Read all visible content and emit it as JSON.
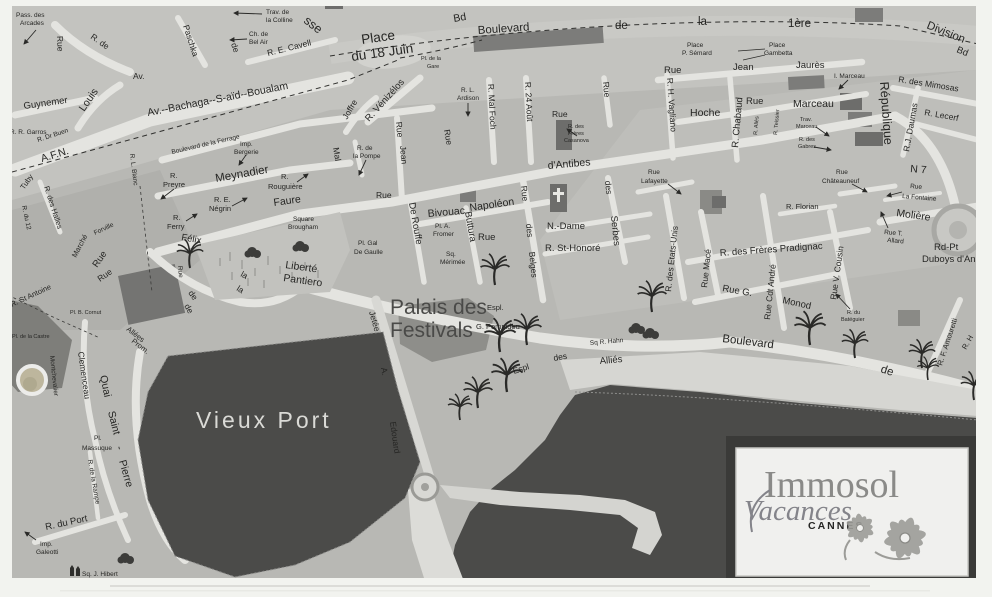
{
  "meta": {
    "description": "Scanned photocopy of a Cannes street map with Immosol Vacances agency logo",
    "colors": {
      "paper": "#f2f3ef",
      "land": "#b8b8b4",
      "road": "#e4e4e0",
      "water": "#4b4b49",
      "block": "#7c7c7a",
      "label": "#262624",
      "logo_gray": "#8a8a88",
      "pen_mark_blue": "#4a66c8"
    }
  },
  "labels": {
    "rue": "Rue",
    "de": "de",
    "la": "la",
    "arcades1": "Pass. des",
    "arcades2": "Arcades",
    "r_de_tl": "R. de",
    "av_tl": "Av.",
    "paschka": "Paschka",
    "colline1": "Trav. de",
    "colline2": "la Colline",
    "belair1": "Ch. de",
    "belair2": "Bel Air",
    "cavell": "R.  E.  Cavell",
    "sse": "sse",
    "place18a": "Place",
    "place18b": "du 18 Juin",
    "gare1": "Pl. de la",
    "gare2": "Gare",
    "bd1": "Bd",
    "blvd": "Boulevard",
    "blvd_la": "la",
    "blvd_1ere": "1ère",
    "blvd_div": "Division",
    "bd2": "Bd",
    "guynemer": "Guynemer",
    "louis": "Louis",
    "garros": "R. R. Garros",
    "buen": "R. Dr Buen",
    "afn": "A.F.N.",
    "bachaga": "Av.--Bachaga--S-aïd--Boualam",
    "ferrage": "Boulevard  de  la  Ferrage",
    "bergerie": "Bergerie",
    "imp": "Imp.",
    "meynadier": "Meynadier",
    "r": "R.",
    "preyre": "Preyre",
    "rouguiere": "Rouguière",
    "negrin1": "R. E.",
    "negrin2": "Négrin",
    "ferry": "Ferry",
    "felix": "Félix",
    "faure": "Faure",
    "brougham1": "Square",
    "brougham2": "Brougham",
    "liberte": "Liberté",
    "pantiero": "Pantiero",
    "gaulle1": "Pl. Gal",
    "gaulle2": "De Gaulle",
    "lblanc": "R. L. Blanc",
    "tuby": "Tuby",
    "halles": "R. des Halles",
    "du12": "R. du 12",
    "marche": "Marché",
    "forville": "Forville",
    "stantoine": "R. St Antoine",
    "castre": "Pl. de la Castre",
    "cornut": "Pl. B. Cornut",
    "montchev": "Montchevalier",
    "clemenceau": "Clemenceau",
    "quai": "Quai",
    "saint": "Saint",
    "tiret": "-",
    "pierre": "Pierre",
    "massuque": "Massuque",
    "pl": "Pl.",
    "rampe": "R. de la Rampe",
    "duport": "R. du Port",
    "galeotti": "Galeotti",
    "hibert": "Sq. J. Hibert",
    "vieuxport": "Vieux  Port",
    "allees": "Allées",
    "prom": "Prom.",
    "joffre": "Joffre",
    "venizelos": "R. Vénizélos",
    "jean": "Jean",
    "mal": "Mal",
    "pompe1": "R. de",
    "pompe2": "la Pompe",
    "ardison1": "R. L.",
    "ardison2": "Ardison",
    "foch": "R. Mal Foch",
    "aout": "R. 24 Août",
    "casanova1": "R. des",
    "casanova2": "Frères",
    "casanova3": "Casanova",
    "dantibes": "d'Antibes",
    "bivouac": "Bivouac",
    "napoleon": "Napoléon",
    "fromer1": "Pl. A.",
    "fromer2": "Fromer",
    "derouffe": "De Rouffe",
    "buttura": "Buttura",
    "merimee1": "Sq.",
    "merimee2": "Mérimée",
    "des": "des",
    "belges": "Belges",
    "ndame": "N.-Dame",
    "honore": "R. St-Honoré",
    "serbes": "Serbes",
    "lafayette": "Lafayette",
    "etatsunis": "R. des Etats-Unis",
    "mace": "Rue   Macé",
    "pradignac": "R. des Frères Pradignac",
    "cdtandre": "Rue   Cdt   André",
    "florian": "R. Florian",
    "chateauneuf": "Châteauneuf",
    "vcousin": "Rue V.   Cousin",
    "rueg": "Rue G.",
    "monod": "Monod",
    "bateguier1": "R. du",
    "bateguier2": "Batéguier",
    "bd_crois": "Boulevard",
    "hahn": "Sq R. Hahn",
    "espl": "Espl",
    "allies": "Alliés",
    "pompidou1": "Espl.",
    "pompidou2": "G. Pompidou",
    "jetee": "Jetée",
    "a_dot": "A.",
    "edouard": "Edouard",
    "palais1": "Palais des",
    "palais2": "Festivals",
    "vagliano": "R. H. Vagliano",
    "hoche": "Hoche",
    "chabaud": "R. Chabaud",
    "marceau": "Marceau",
    "imarceau": "I. Marceau",
    "trav": "Trav.",
    "gabres": "Gabres",
    "jaures": "Jaurès",
    "place": "Place",
    "semard": "P. Sémard",
    "gambetta": "Gambetta",
    "alies": "R. Aliès",
    "teissier": "R. Teissier",
    "republique": "République",
    "mimosas": "R. des  Mimosas",
    "daumas": "R.J. Daumas",
    "lecerf": "R. Lecerf",
    "n7": "N 7",
    "fontaine": "La Fontaine",
    "moliere": "Molière",
    "tallard1": "Rue T.",
    "tallard2": "Allard",
    "rdpt1": "Rd-Pt",
    "rdpt2": "Duboys d'Angers",
    "amouretti": "R. F. Amouretti",
    "rh": "R. H"
  },
  "logo": {
    "brand": "Immosol",
    "sub": "Vacances",
    "city": "CANNES"
  }
}
